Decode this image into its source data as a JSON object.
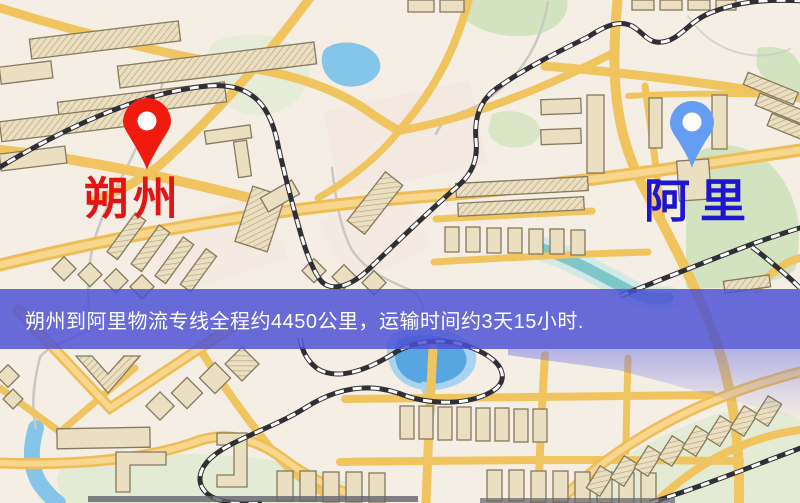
{
  "banner": {
    "text": "朔州到阿里物流专线全程约4450公里，运输时间约3天15小时.",
    "background_color": "rgba(76,81,212,0.84)",
    "text_color": "#ffffff"
  },
  "markers": {
    "origin": {
      "label": "朔州",
      "pin_color": "#f01a0e",
      "pin_hole_color": "#ffffff",
      "label_color": "#e51414"
    },
    "destination": {
      "label": "阿里",
      "pin_color": "#659df2",
      "pin_hole_color": "#ffffff",
      "label_color": "#1d15cf"
    }
  },
  "route": {
    "origin_city": "朔州",
    "destination_city": "阿里",
    "distance_text": "约4450公里",
    "duration_text": "约3天15小时"
  },
  "map": {
    "palette": {
      "bg": "#f5eee4",
      "pink": "#f4e7e0",
      "road": "#eebd55",
      "roadcenter": "#f7d68d",
      "roadminor": "#f0c45f",
      "park": "#d3e3c0",
      "parkpale": "#e3ebd4",
      "water": "#86c5ea",
      "lakecore": "#57a6e2",
      "lakerim": "#a9d4f0",
      "teal": "#7fc6cb",
      "tealight": "#d2eae6",
      "river": "#c9c8c4",
      "rail": "#2f2f35",
      "raildash": "#ffffff",
      "bldg": "#eadfc0",
      "bldgstroke": "#85795e",
      "hatch": "#b7a77f",
      "darkrow": "#62626b"
    }
  }
}
